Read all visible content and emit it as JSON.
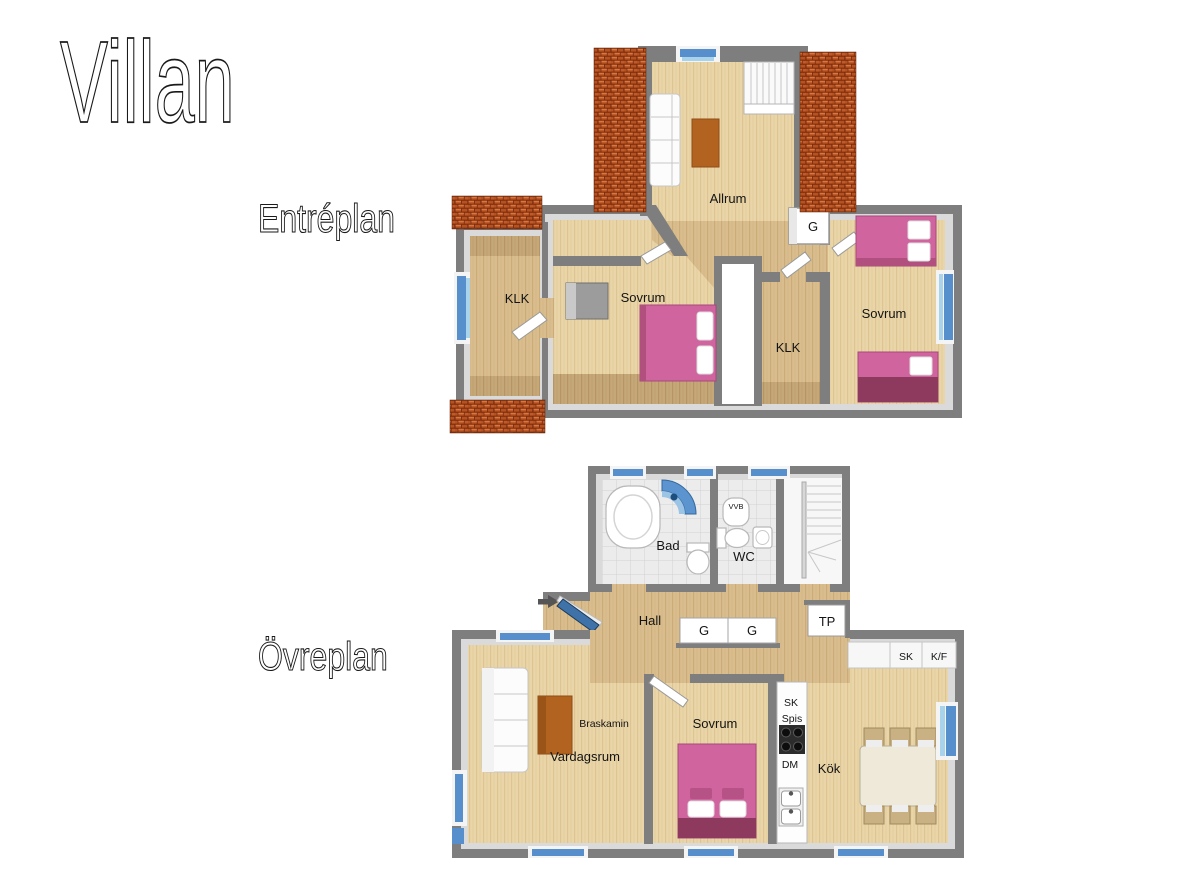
{
  "title": "Villan",
  "plan1": {
    "label": "Entréplan",
    "rooms": {
      "allrum": "Allrum",
      "g": "G",
      "klk_left": "KLK",
      "sovrum_mid": "Sovrum",
      "klk_mid": "KLK",
      "sovrum_right": "Sovrum"
    }
  },
  "plan2": {
    "label": "Övreplan",
    "rooms": {
      "bad": "Bad",
      "vvb": "VVB",
      "wc": "WC",
      "hall": "Hall",
      "g1": "G",
      "g2": "G",
      "tp": "TP",
      "sk_top": "SK",
      "kf": "K/F",
      "braskamin": "Braskamin",
      "vardagsrum": "Vardagsrum",
      "sovrum": "Sovrum",
      "sk_col": "SK",
      "spis": "Spis",
      "dm": "DM",
      "kok": "Kök"
    }
  },
  "colors": {
    "wall": "#7e7e7e",
    "floor_light": "#e9d5a7",
    "floor_dark": "#c5a878",
    "roof_tile": "#c05a28",
    "window_blue": "#568fcb",
    "bed_pink": "#cf649e",
    "furniture_wood": "#b2631f"
  }
}
